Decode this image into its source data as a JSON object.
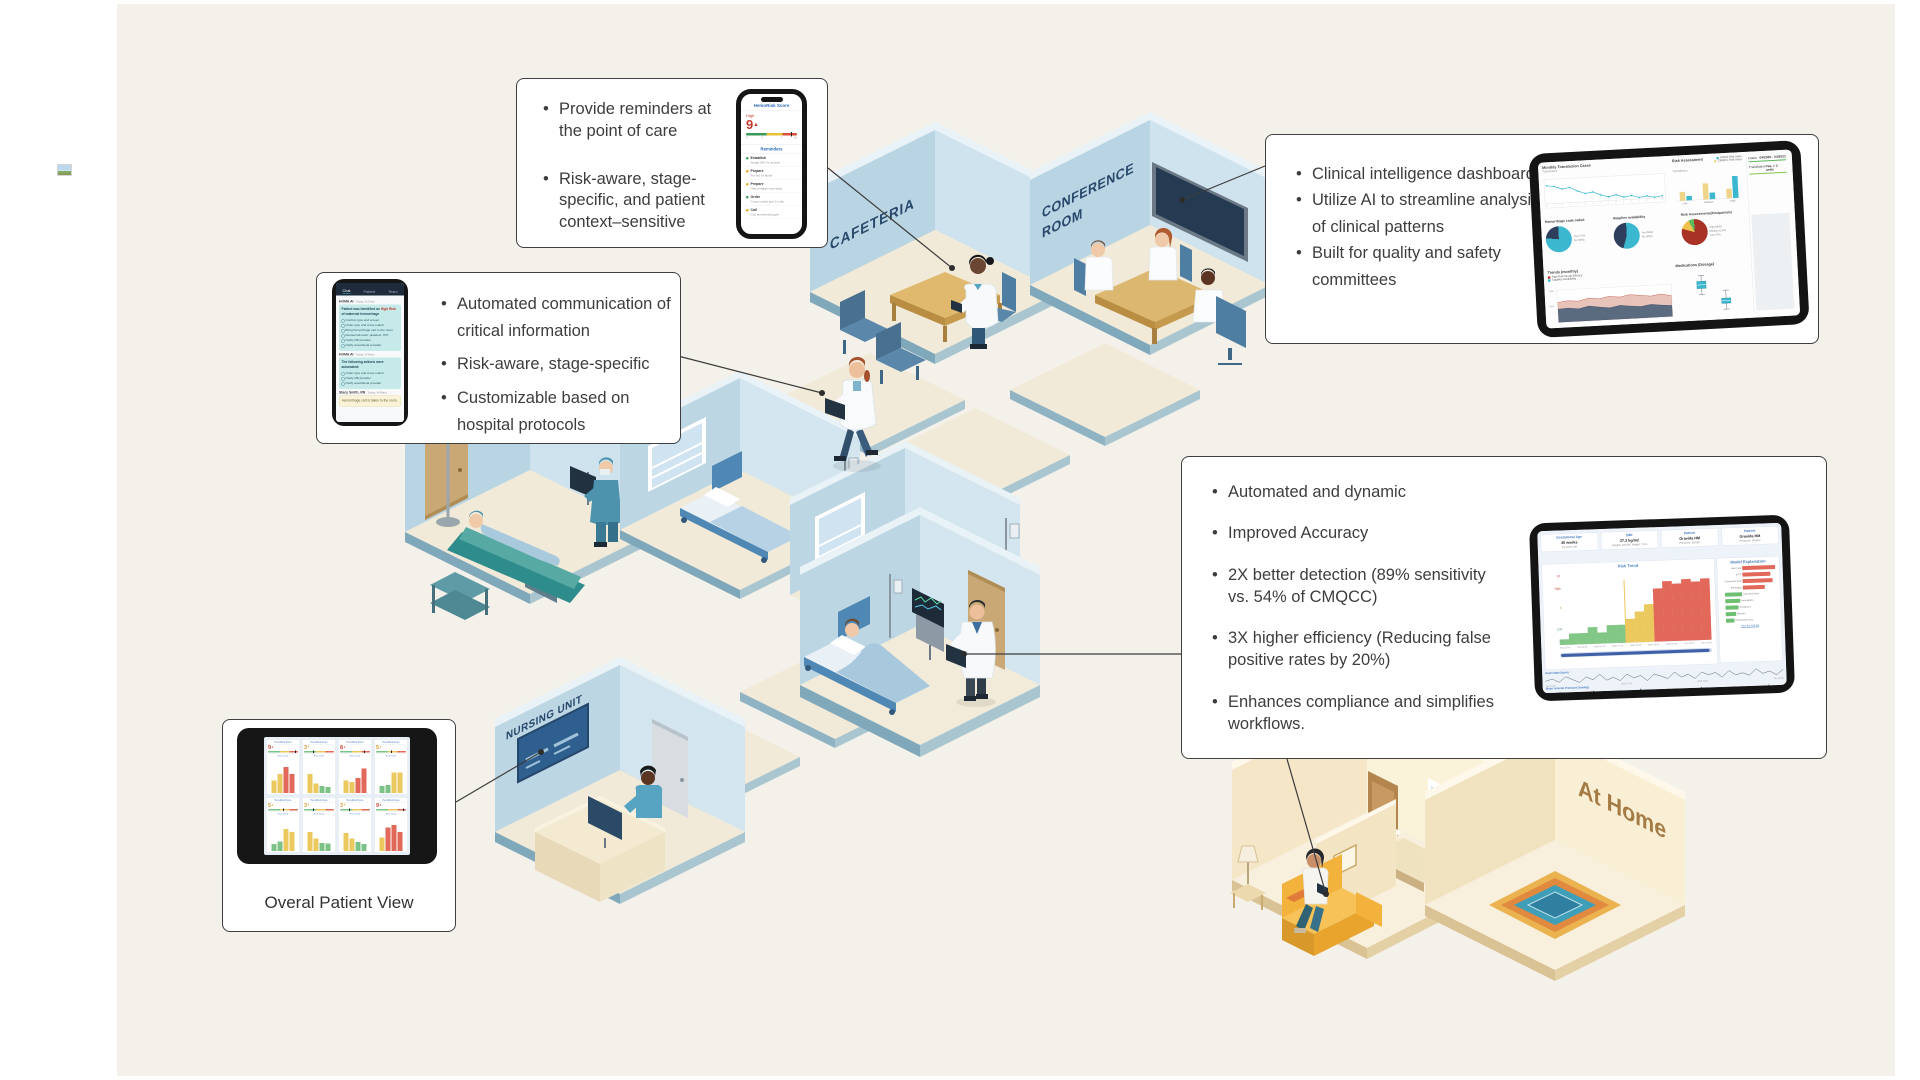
{
  "canvas": {
    "bg": "#f4f1eb"
  },
  "scene": {
    "labels": {
      "cafeteria": "CAFETERIA",
      "conference_1": "CONFERENCE",
      "conference_2": "ROOM",
      "nursing": "NURSING UNIT",
      "home": "At Home"
    }
  },
  "callouts": {
    "reminders": {
      "bullets": [
        "Provide reminders at the point of care",
        "Risk-aware, stage-specific, and patient context–sensitive"
      ],
      "phone": {
        "title": "HemoRisk Score",
        "risk_label": "High",
        "score": "9",
        "score_arrow": "▲",
        "scale": [
          "0",
          "3",
          "7",
          "10"
        ],
        "section": "Reminders",
        "items": [
          {
            "action": "Establish",
            "detail": "Single 18G IV access",
            "status": "green"
          },
          {
            "action": "Prepare",
            "detail": "For NS IV fluids",
            "status": "yellow"
          },
          {
            "action": "Prepare",
            "detail": "Hemorrhage cart ready",
            "status": "yellow"
          },
          {
            "action": "Order",
            "detail": "Cross match and 2 units",
            "status": "green"
          },
          {
            "action": "Call",
            "detail": "Call anesthesiologist",
            "status": "yellow"
          }
        ]
      }
    },
    "communication": {
      "bullets": [
        "Automated communication of critical information",
        "Risk-aware, stage-specific",
        "Customizable based on hospital protocols"
      ],
      "phone": {
        "tabs": [
          "Chat",
          "Patient",
          "Team"
        ],
        "messages": [
          {
            "sender": "HOMA AI",
            "time": "Today, 8:27am",
            "lead": "Patient was identified as ",
            "highlight": "High Risk",
            "lead_end": " of maternal hemorrhage",
            "items": [
              "Confirm type and screen",
              "Order type and cross match",
              "Bring hemorrhage cart to the room",
              "Review lab work: platelets, H/H",
              "Notify OB provider",
              "Notify anesthesia provider"
            ]
          },
          {
            "sender": "HOMA AI",
            "time": "Today, 8:36am",
            "lead": "The following actions were automated:",
            "items": [
              "Order type and cross match",
              "Notify OB provider",
              "Notify anesthesia provider"
            ]
          },
          {
            "sender": "Stacy Smith, RN",
            "time": "Today, 8:40am",
            "lead": "Hemorrhage cart is taken to the room."
          }
        ]
      }
    },
    "dashboard": {
      "bullets": [
        "Clinical intelligence dashboard",
        "Utilize AI to streamline analysis of clinical patterns",
        "Built for quality and safety committees"
      ]
    },
    "detection": {
      "bullets": [
        "Automated and dynamic",
        "Improved Accuracy",
        "2X better detection (89% sensitivity vs. 54% of CMQCC)",
        "3X higher efficiency (Reducing false positive rates by 20%)",
        "Enhances compliance and simplifies workflows."
      ]
    },
    "overview": {
      "caption": "Overal Patient View"
    }
  },
  "chart_data": {
    "clinical_dashboard": {
      "monthly_transfusion": {
        "type": "line",
        "title": "Monthly Transfusion Cases",
        "series_label": "Transfusion",
        "values": [
          8.2,
          8.0,
          7.5,
          7.7,
          7.0,
          6.5,
          6.7,
          6.1,
          5.7,
          6.0,
          5.5,
          5.7,
          5.3,
          5.5,
          5.2,
          5.4
        ],
        "color": "#3bb8d0"
      },
      "risk_assessment": {
        "type": "bar",
        "title": "Risk Assessment",
        "series_label": "Transfusion",
        "legend": [
          "HOMA Risk Index",
          "CMQCC Risk Index"
        ],
        "legend_colors": [
          "#3bb8d0",
          "#f0d48a"
        ],
        "categories": [
          "Low",
          "Medium",
          "High"
        ],
        "series": [
          {
            "name": "CMQCC Risk Index",
            "color": "#f0d48a",
            "values": [
              12,
              22,
              13
            ]
          },
          {
            "name": "HOMA Risk Index",
            "color": "#3bb8d0",
            "values": [
              6,
              9,
              30
            ]
          }
        ]
      },
      "pies": [
        {
          "type": "pie",
          "title": "Hemorrhage code called",
          "slices": [
            {
              "label": "Yes (77%)",
              "value": 77,
              "color": "#3bb8d0"
            },
            {
              "label": "No (23%)",
              "value": 23,
              "color": "#2e3f5c"
            }
          ]
        },
        {
          "type": "pie",
          "title": "Supplies availability",
          "slices": [
            {
              "label": "Yes (55%)",
              "value": 55,
              "color": "#3bb8d0"
            },
            {
              "label": "No (45%)",
              "value": 45,
              "color": "#2e3f5c"
            }
          ]
        },
        {
          "type": "pie",
          "title": "Risk Assessments(Postpartum)",
          "slices": [
            {
              "label": "High (80%)",
              "value": 80,
              "color": "#a93226"
            },
            {
              "label": "Medium (13%)",
              "value": 13,
              "color": "#f0c14b"
            },
            {
              "label": "Low (7%)",
              "value": 7,
              "color": "#5cb85c"
            }
          ]
        }
      ],
      "trends": {
        "type": "area",
        "title": "Trends (monthly)",
        "legend": [
          {
            "label": "High Risk Group Efficacy",
            "color": "#c0392b"
          },
          {
            "label": "Supplies Availability",
            "color": "#3bb8d0"
          }
        ],
        "series": [
          {
            "name": "High Risk Group Efficacy",
            "color": "#e7c3ba",
            "values": [
              62,
              66,
              63,
              71,
              67,
              73,
              69,
              75,
              71,
              67,
              72,
              65
            ]
          },
          {
            "name": "Supplies Availability",
            "color": "#5a6b80",
            "values": [
              41,
              43,
              39,
              46,
              41,
              37,
              43,
              39,
              36,
              41,
              37,
              34
            ]
          }
        ],
        "yticks": [
          "70%",
          "50%"
        ]
      },
      "medications": {
        "type": "box",
        "title": "Medications (Dosage)"
      },
      "sidebar": {
        "rows": [
          {
            "label": "Dates",
            "value": "04/2020 - 04/2021"
          },
          {
            "label": "Transfusion",
            "value": "Yes, > 2 units"
          }
        ]
      }
    },
    "risk_trend_dashboard": {
      "stats": [
        {
          "title": "Gestational Age",
          "value": "30 weeks",
          "sub": "24 years old"
        },
        {
          "title": "BMI",
          "value": "27.3 kg/m2",
          "sub": "Weight: 160 lbs, Height: 70 in"
        },
        {
          "title": "Patient",
          "value": "Gravida HM",
          "sub": "Pressure: Shorter"
        },
        {
          "title": "Patient",
          "value": "Gravida HM",
          "sub": "Pressure: Shorter"
        }
      ],
      "risk_trend": {
        "type": "step-area",
        "title": "Risk Trend",
        "yticks": [
          {
            "label": "10",
            "color": "#c0392b"
          },
          {
            "label": "High",
            "color": "#c0392b"
          },
          {
            "label": "5",
            "color": "#b8860b"
          },
          {
            "label": "Low",
            "color": "#3a9a5c"
          },
          {
            "label": "0",
            "color": "#999999"
          }
        ],
        "xticks": [
          "Tue 16:00",
          "Tue 23:00",
          "Wed 03:10",
          "Wed 07:30",
          "Wed 11:40",
          "Wed 16:00",
          "Wed 20:10",
          "Thu 00:30",
          "Thu 05:00"
        ],
        "segments": [
          {
            "color": "#82c785",
            "values": [
              8,
              16,
              16,
              24,
              16,
              26,
              26
            ]
          },
          {
            "color": "#ecc95e",
            "values": [
              34,
              44,
              54
            ]
          },
          {
            "color": "#e2685a",
            "values": [
              76,
              86,
              82,
              88,
              84,
              88
            ]
          }
        ]
      },
      "model_explanation": {
        "title": "Model Explanation",
        "positive_color": "#e2685a",
        "negative_color": "#6fbf73",
        "positive": [
          {
            "label": "Heart rate",
            "w": 66
          },
          {
            "label": "aPTT",
            "w": 56
          },
          {
            "label": "Cholesterol level",
            "w": 60
          },
          {
            "label": "Fibrinogen",
            "w": 44
          }
        ],
        "negative": [
          {
            "label": "Last blood draw",
            "w": 34
          },
          {
            "label": "Hemoglobin",
            "w": 30
          },
          {
            "label": "Hematocrit",
            "w": 26
          },
          {
            "label": "Bilirubin",
            "w": 21
          },
          {
            "label": "Prothrombin time",
            "w": 17
          }
        ],
        "link": "See the full list"
      },
      "vitals": [
        {
          "title": "Heart Rate (bpm)",
          "style": "line",
          "color": "#3a4754",
          "values": [
            74,
            79,
            71,
            83,
            76,
            69,
            81,
            74,
            86,
            72,
            78,
            70,
            84,
            75,
            80,
            68,
            82,
            77,
            71,
            85,
            73,
            79,
            69,
            83,
            76,
            81,
            70,
            84,
            74,
            78,
            72,
            86,
            75,
            80,
            71,
            83
          ]
        },
        {
          "title": "Mean Arterial Pressure (mmHg)",
          "style": "bars",
          "color": "#3a4754",
          "values": [
            88,
            84,
            91,
            86,
            82,
            90,
            85,
            92,
            87,
            83,
            89,
            84,
            90,
            86,
            93,
            85,
            88,
            83,
            91,
            87,
            84,
            90,
            85,
            92,
            86,
            89,
            83,
            90,
            87,
            91,
            84,
            88,
            85,
            92,
            86,
            89
          ]
        }
      ],
      "vitals_xticks": [
        "Tue 23:00",
        "Wed 07:30",
        "Wed 16:00",
        "Thu 00:30"
      ]
    },
    "overview_grid": {
      "card_title": "HemoRisk Score",
      "trend_label": "Risk Trend",
      "bar_colors": {
        "y": "#ecc95e",
        "r": "#e2685a",
        "g": "#7cc287"
      },
      "cards": [
        {
          "score": "9",
          "arrow": "▲",
          "color": "#c44536",
          "bars": [
            {
              "h": 45,
              "c": "y"
            },
            {
              "h": 70,
              "c": "y"
            },
            {
              "h": 95,
              "c": "r"
            },
            {
              "h": 70,
              "c": "r"
            }
          ]
        },
        {
          "score": "3",
          "arrow": "▼",
          "color": "#d99a2b",
          "bars": [
            {
              "h": 70,
              "c": "y"
            },
            {
              "h": 35,
              "c": "y"
            },
            {
              "h": 25,
              "c": "g"
            },
            {
              "h": 22,
              "c": "g"
            }
          ]
        },
        {
          "score": "8",
          "arrow": "▲",
          "color": "#c44536",
          "bars": [
            {
              "h": 45,
              "c": "y"
            },
            {
              "h": 40,
              "c": "y"
            },
            {
              "h": 55,
              "c": "r"
            },
            {
              "h": 90,
              "c": "r"
            }
          ]
        },
        {
          "score": "5",
          "arrow": "▲",
          "color": "#d99a2b",
          "bars": [
            {
              "h": 25,
              "c": "g"
            },
            {
              "h": 30,
              "c": "g"
            },
            {
              "h": 75,
              "c": "y"
            },
            {
              "h": 75,
              "c": "y"
            }
          ]
        },
        {
          "score": "5",
          "arrow": "▲",
          "color": "#d99a2b",
          "bars": [
            {
              "h": 25,
              "c": "g"
            },
            {
              "h": 35,
              "c": "g"
            },
            {
              "h": 80,
              "c": "y"
            },
            {
              "h": 70,
              "c": "y"
            }
          ]
        },
        {
          "score": "3",
          "arrow": "▼",
          "color": "#d99a2b",
          "bars": [
            {
              "h": 70,
              "c": "y"
            },
            {
              "h": 45,
              "c": "y"
            },
            {
              "h": 30,
              "c": "g"
            },
            {
              "h": 28,
              "c": "g"
            }
          ]
        },
        {
          "score": "3",
          "arrow": "▼",
          "color": "#d99a2b",
          "bars": [
            {
              "h": 65,
              "c": "y"
            },
            {
              "h": 45,
              "c": "y"
            },
            {
              "h": 32,
              "c": "g"
            },
            {
              "h": 25,
              "c": "g"
            }
          ]
        },
        {
          "score": "9",
          "arrow": "▲",
          "color": "#c44536",
          "bars": [
            {
              "h": 50,
              "c": "y"
            },
            {
              "h": 85,
              "c": "r"
            },
            {
              "h": 95,
              "c": "r"
            },
            {
              "h": 70,
              "c": "r"
            }
          ]
        }
      ]
    }
  }
}
